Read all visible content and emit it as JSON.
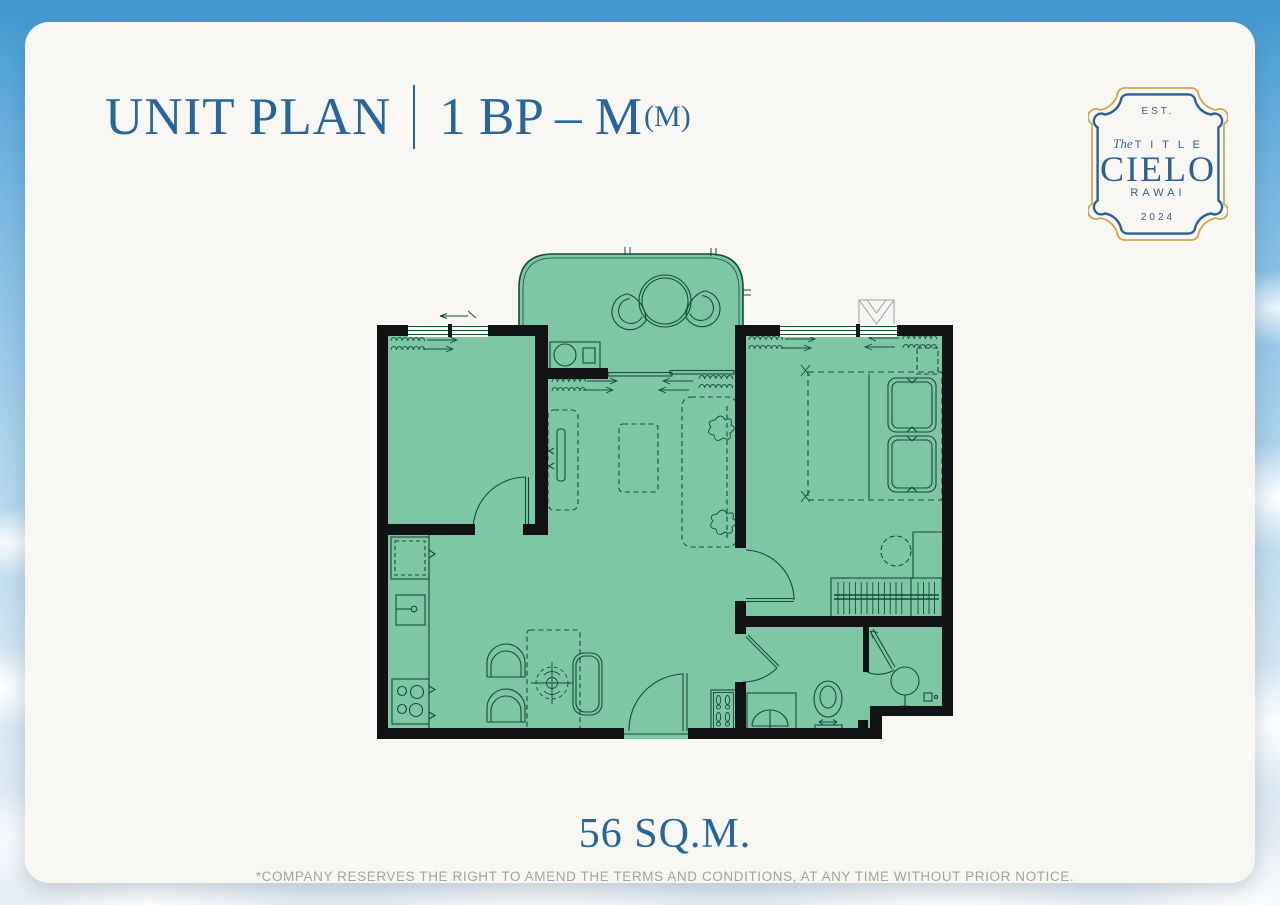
{
  "header": {
    "title": "UNIT PLAN",
    "unit_code": "1 BP – M",
    "unit_code_suffix": "(M)"
  },
  "logo": {
    "est": "EST.",
    "brand_script": "The",
    "brand_word": "T I T L E",
    "name": "CIELO",
    "location": "RAWAI",
    "year": "2024"
  },
  "footer": {
    "area": "56 SQ.M.",
    "disclaimer": "*COMPANY RESERVES THE RIGHT TO AMEND THE TERMS AND CONDITIONS,  AT ANY TIME WITHOUT PRIOR NOTICE."
  },
  "colors": {
    "accent_blue": "#28659c",
    "logo_blue": "#2d5f95",
    "logo_gold": "#cfa552",
    "card_bg": "#f8f7f3",
    "plan_fill": "#7ec7a4",
    "plan_line": "#14493c",
    "wall_black": "#101213",
    "disclaimer_gray": "#a3a3a3"
  },
  "plan": {
    "fixtures": [
      "balcony-table",
      "balcony-chairs",
      "washing-machine",
      "sliding-door",
      "curtains",
      "tv-console",
      "tv",
      "coffee-table",
      "sofa",
      "plants",
      "dining-table",
      "dining-chairs",
      "bench",
      "ceiling-light",
      "fridge",
      "kitchen-sink",
      "stove",
      "bed",
      "pillows",
      "nightstand",
      "wardrobe",
      "dressing-table",
      "stool",
      "toilet",
      "bathroom-sink",
      "shower",
      "shoe-cabinet",
      "entrance-door",
      "bedroom-door",
      "bathroom-door",
      "windows"
    ]
  }
}
